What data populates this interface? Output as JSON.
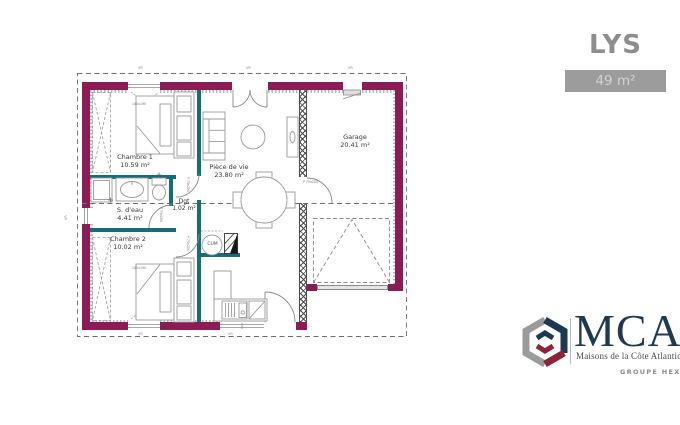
{
  "header": {
    "model_name": "LYS",
    "area_badge": "49 m²"
  },
  "plan": {
    "rooms": [
      {
        "name": "Chambre 1",
        "area": "10.59 m²"
      },
      {
        "name": "S. d'eau",
        "area": "4.41 m²"
      },
      {
        "name": "Dgt",
        "area": "1.02 m²"
      },
      {
        "name": "Chambre 2",
        "area": "10.02 m²"
      },
      {
        "name": "Pièce de vie",
        "area": "23.80 m²"
      },
      {
        "name": "Garage",
        "area": "20.41 m²"
      }
    ],
    "tags": {
      "bed_size": "140x190",
      "water_heater": "CUM",
      "door_tag": "P 75x204",
      "shutter_tag": "VR"
    },
    "colors": {
      "exterior_wall": "#8b1d54",
      "partition_wall": "#156e76",
      "furniture_line": "#9a9a9a"
    }
  },
  "branding": {
    "logo_text": "MCA",
    "logo_subtitle": "Maisons de la Côte Atlantique",
    "group_label": "GROUPE HEXAOM",
    "colors": {
      "navy": "#1e3a52",
      "red": "#8e2436",
      "gray": "#9b9b9d"
    }
  }
}
